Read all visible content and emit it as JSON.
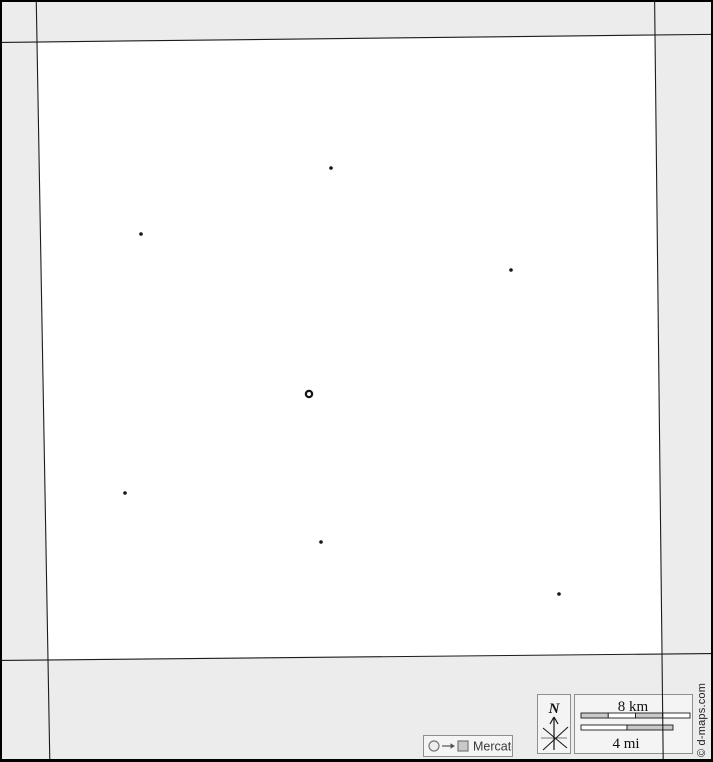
{
  "canvas": {
    "width": 713,
    "height": 762
  },
  "colors": {
    "margin_bg": "#ececec",
    "land": "#ffffff",
    "boundary": "#1c1c1c",
    "marker": "#151515",
    "panel_bg": "#f4f4f4",
    "panel_border": "#8f8f8f",
    "scale_gray": "#c9c9c9",
    "scale_white": "#ffffff"
  },
  "map": {
    "corners": {
      "top_left": [
        35,
        40
      ],
      "top_right": [
        653,
        33
      ],
      "bottom_right": [
        660,
        652
      ],
      "bottom_left": [
        46,
        658
      ]
    },
    "capital": {
      "x": 307,
      "y": 392,
      "style": "ring"
    },
    "cities": [
      {
        "x": 329,
        "y": 166
      },
      {
        "x": 139,
        "y": 232
      },
      {
        "x": 509,
        "y": 268
      },
      {
        "x": 123,
        "y": 491
      },
      {
        "x": 319,
        "y": 540
      },
      {
        "x": 557,
        "y": 592
      }
    ]
  },
  "compass": {
    "north_label": "N"
  },
  "scale_bar": {
    "km_label": "8 km",
    "mi_label": "4 mi",
    "km_fills": [
      "#c9c9c9",
      "#ffffff",
      "#c9c9c9",
      "#ffffff"
    ],
    "mi_fills": [
      "#ffffff",
      "#c9c9c9"
    ]
  },
  "projection": {
    "label": "Mercator"
  },
  "credit": {
    "text": "© d-maps.com"
  }
}
